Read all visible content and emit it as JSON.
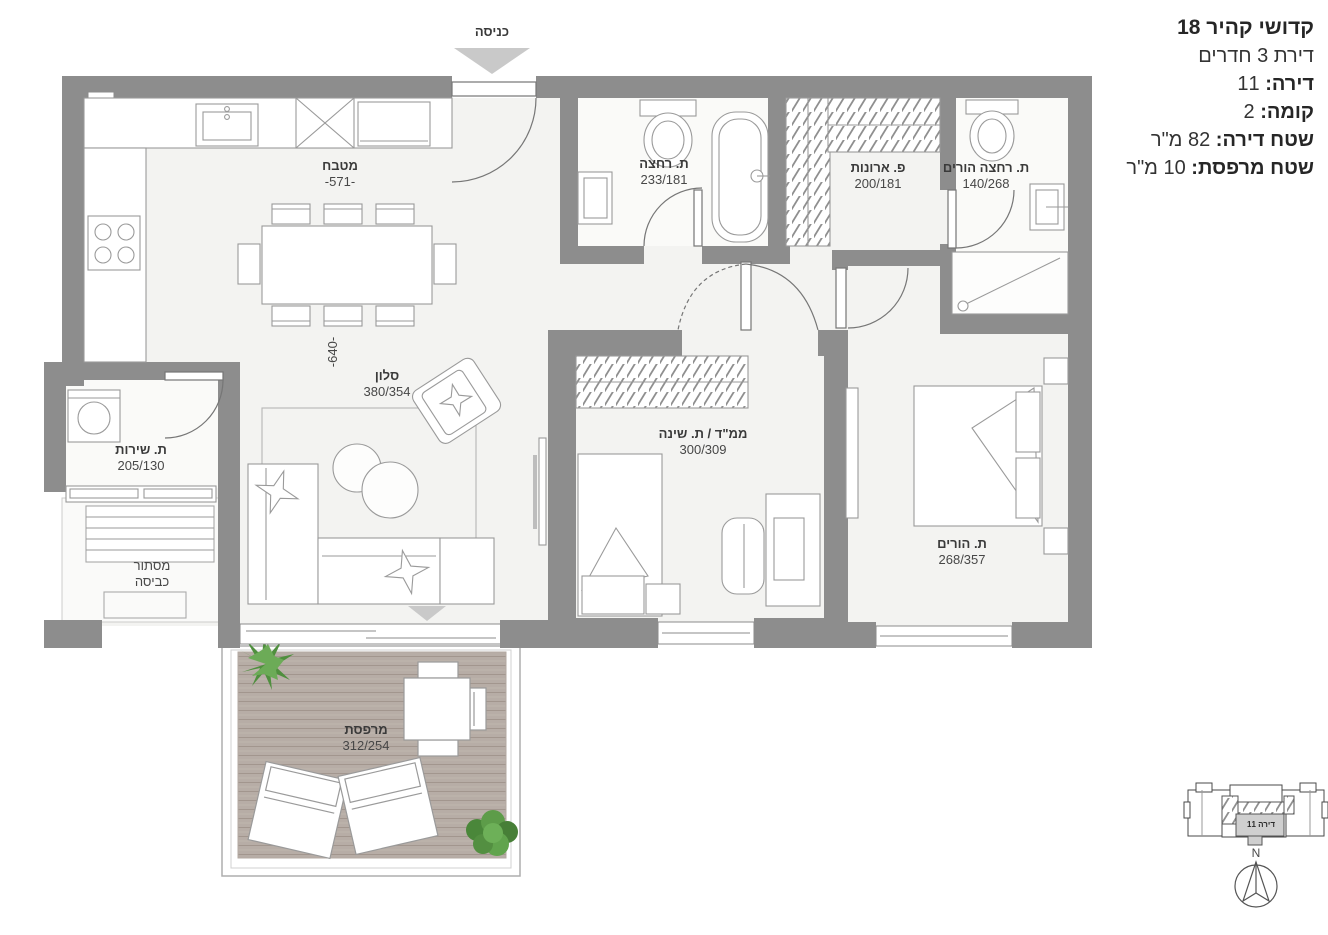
{
  "header": {
    "project_title": "קדושי קהיר 18",
    "apartment_type": "דירת 3 חדרים",
    "apartment_label": "דירה:",
    "apartment_value": "11",
    "floor_label": "קומה:",
    "floor_value": "2",
    "apartment_area_label": "שטח דירה:",
    "apartment_area_value": "82 מ\"ר",
    "balcony_area_label": "שטח מרפסת:",
    "balcony_area_value": "10 מ\"ר"
  },
  "plan": {
    "entrance_label": "כניסה",
    "rooms": {
      "kitchen": {
        "name": "מטבח",
        "dim": "-571-"
      },
      "kitchen_width_dim": "-640-",
      "living": {
        "name": "סלון",
        "dim": "380/354"
      },
      "bath": {
        "name": "ת. רחצה",
        "dim": "233/181"
      },
      "closets": {
        "name": "פ. ארונות",
        "dim": "200/181"
      },
      "parents_bath": {
        "name": "ת. רחצה הורים",
        "dim": "140/268"
      },
      "mamad": {
        "name": "ממ\"ד / ת. שינה",
        "dim": "300/309"
      },
      "parents_room": {
        "name": "ת. הורים",
        "dim": "268/357"
      },
      "service_bath": {
        "name": "ת. שירות",
        "dim": "205/130"
      },
      "laundry": {
        "name_line1": "מסתור",
        "name_line2": "כביסה"
      },
      "balcony": {
        "name": "מרפסת",
        "dim": "312/254"
      }
    }
  },
  "keyplan": {
    "unit_label": "דירה 11"
  },
  "compass": {
    "north_label": "N"
  },
  "colors": {
    "wall": "#8d8d8d",
    "floor": "#f3f3f1",
    "deck": "#b7ada6",
    "line": "#9a9a9a",
    "arrow": "#c9c9c9"
  }
}
